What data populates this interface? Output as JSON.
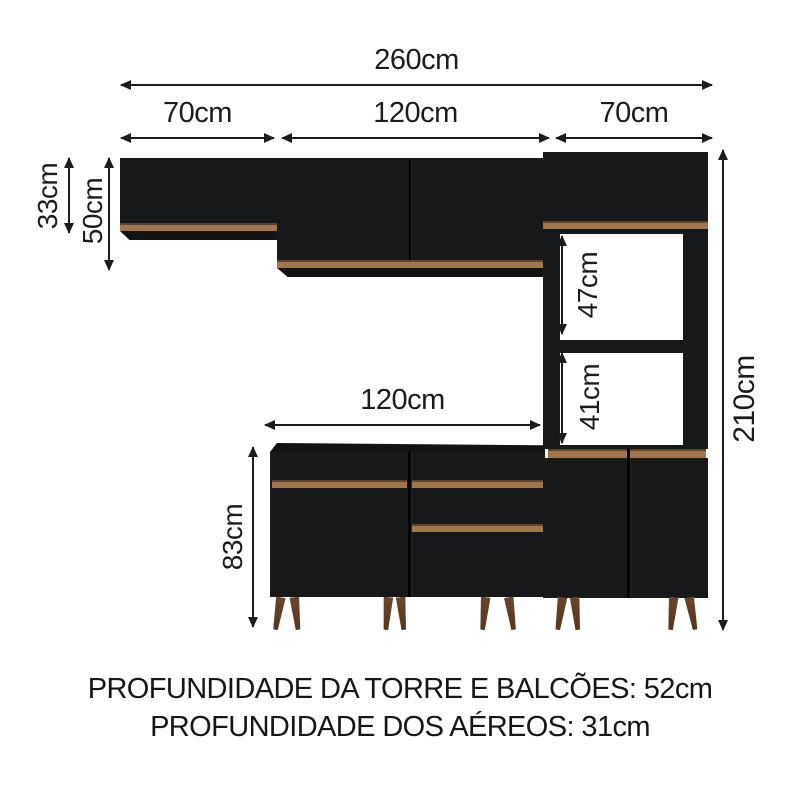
{
  "diagram": {
    "title": "kitchen-cabinet-set-dimension-drawing",
    "dimensions": {
      "total_width": "260cm",
      "upper_left_width": "70cm",
      "upper_middle_width": "120cm",
      "upper_right_width": "70cm",
      "left_aerial_height": "33cm",
      "middle_aerial_height": "50cm",
      "tower_upper_shelf_height": "47cm",
      "tower_lower_shelf_height": "41cm",
      "total_height": "210cm",
      "base_cabinet_width": "120cm",
      "base_cabinet_height": "83cm"
    },
    "footer": {
      "line1": "PROFUNDIDADE DA TORRE E BALCÕES: 52cm",
      "line2": "PROFUNDIDADE DOS AÉREOS: 31cm"
    },
    "colors": {
      "cabinet_body": "#17181a",
      "wood_accent": "#a0764a",
      "leg_wood": "#5d3b25",
      "dimension_ink": "#1c1c1c",
      "background": "#ffffff"
    }
  }
}
